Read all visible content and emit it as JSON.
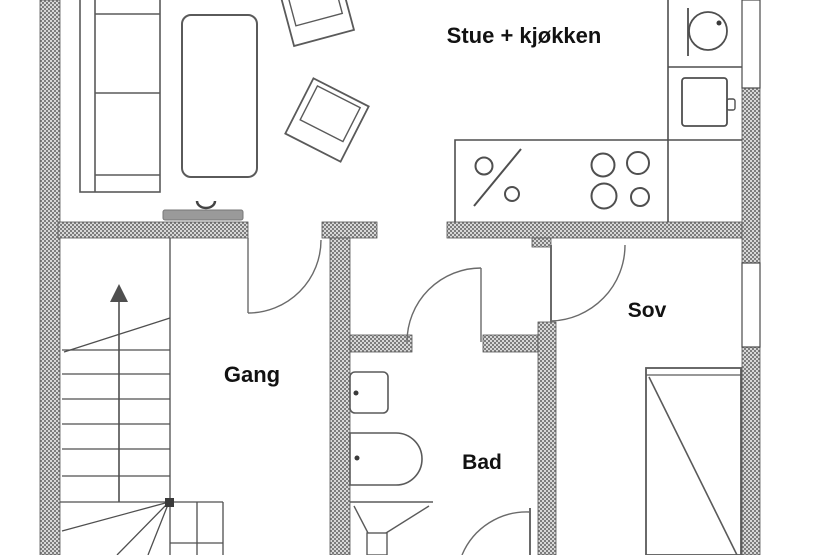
{
  "plan": {
    "type": "floor-plan",
    "labels": {
      "living_kitchen": "Stue + kjøkken",
      "hallway": "Gang",
      "bathroom": "Bad",
      "bedroom": "Sov"
    }
  },
  "colors": {
    "background": "#ffffff",
    "wall_hatch_dark": "#7d7d7d",
    "wall_hatch_light": "#d8d8d8",
    "wall_outline": "#555555",
    "line": "#4f4f4f",
    "door_line": "#6a6a6a",
    "text": "#121212",
    "bench_fill": "#9a9a9a"
  },
  "symbols": {
    "stairs": "stairs-with-up-arrow-symbol",
    "sofa": "sofa-symbol",
    "table": "table-symbol",
    "chairs": "chair-symbol",
    "bench": "wall-bench-symbol",
    "kitchen_sink": "round-sink-symbol",
    "oven": "oven-symbol",
    "counter_sink": "counter-sink-symbol",
    "cooktop": "cooktop-burners-symbol",
    "bed": "bed-symbol",
    "bath_sink": "washbasin-symbol",
    "bathtub": "bathtub-symbol",
    "toilet": "toilet-symbol",
    "door": "door-swing-symbol",
    "window": "window-symbol"
  }
}
